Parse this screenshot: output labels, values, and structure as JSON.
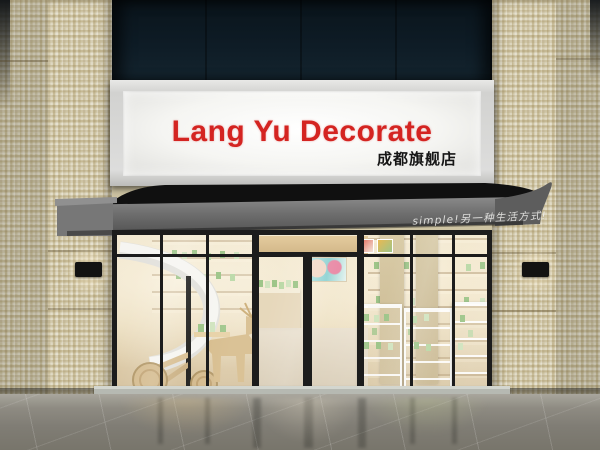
{
  "scene": {
    "description": "3D architectural render of a cosmetics shop storefront at street level",
    "sign": {
      "title": "Lang Yu Decorate",
      "subtitle": "成都旗舰店",
      "title_color": "#d42421",
      "subtitle_color": "#161616",
      "panel_color": "#f7f7f4"
    },
    "awning": {
      "slogan": "simple!另一种生活方式!",
      "slogan_color": "#f2f2f0",
      "fabric_color": "#6b6b6b"
    },
    "palette": {
      "facade_tile": "#cdc3a2",
      "upper_glass": "#0d1b26",
      "frame_black": "#1c1c1c",
      "interior_warm": "#ecdfc2",
      "product_green": "#9cc487",
      "wood_tan": "#d8bf93",
      "staircase_white": "#f3f2ee",
      "floor_grey": "#8d8a81"
    }
  }
}
